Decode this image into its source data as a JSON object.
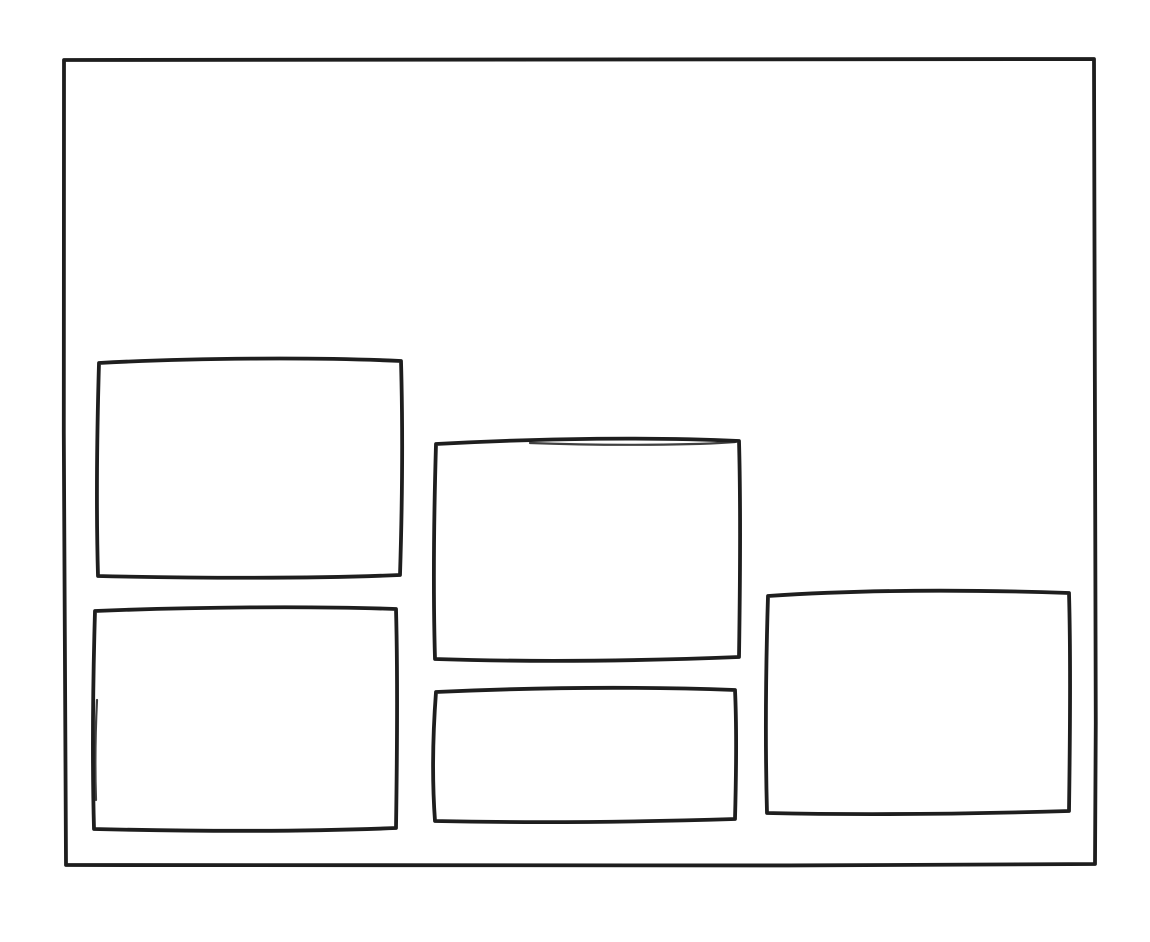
{
  "canvas": {
    "background_color": "#ffffff",
    "stroke_color": "#1e1e1e"
  },
  "shapes": {
    "outer_frame": {
      "label": "outer-frame"
    },
    "boxes": [
      {
        "label": "box-top-left"
      },
      {
        "label": "box-middle"
      },
      {
        "label": "box-right"
      },
      {
        "label": "box-bottom-left"
      },
      {
        "label": "box-bottom-middle"
      }
    ]
  }
}
